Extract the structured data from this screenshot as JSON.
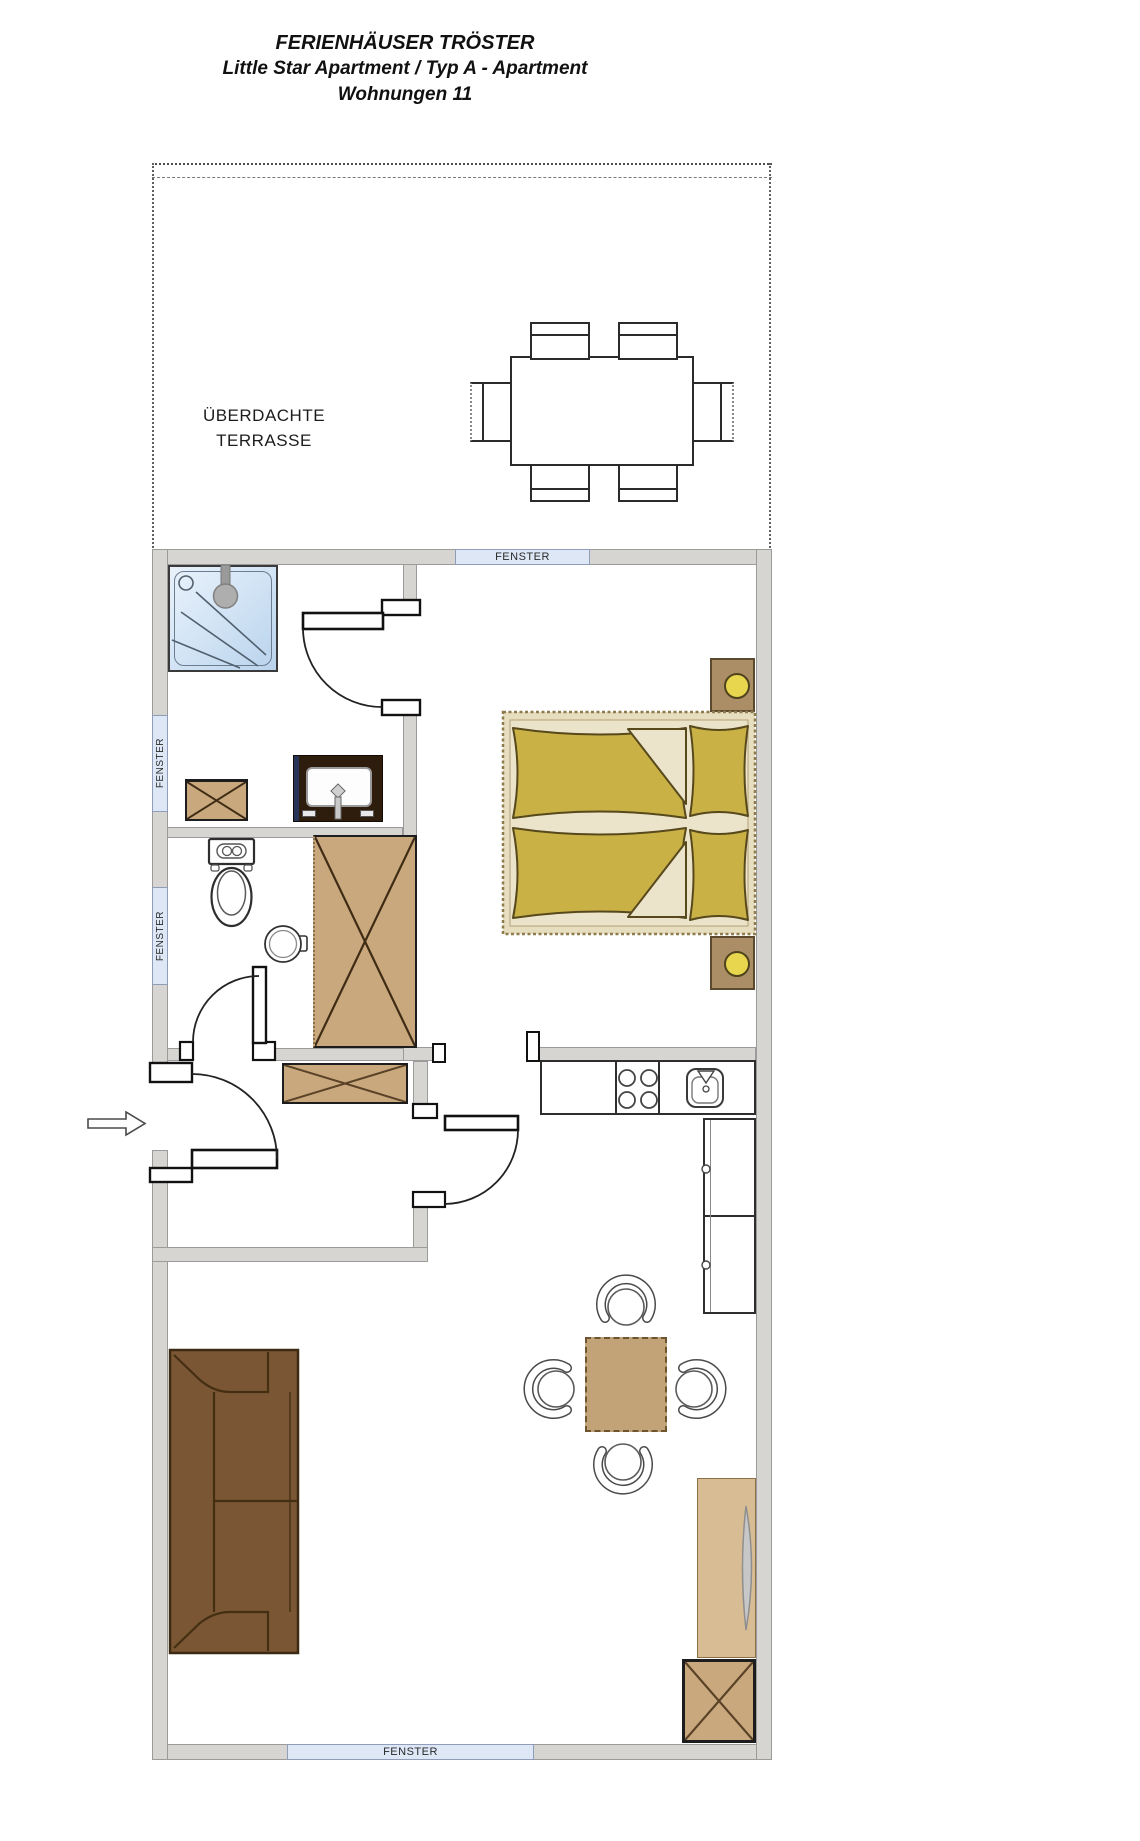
{
  "title": {
    "line1": "FERIENHÄUSER TRÖSTER",
    "line2": "Little Star Apartment / Typ A - Apartment",
    "line3": "Wohnungen 11"
  },
  "terrace": {
    "label_line1": "ÜBERDACHTE",
    "label_line2": "TERRASSE"
  },
  "windows": {
    "top": {
      "label": "FENSTER"
    },
    "left_upper": {
      "label": "FENSTER"
    },
    "left_lower": {
      "label": "FENSTER"
    },
    "bottom": {
      "label": "FENSTER"
    }
  },
  "fixtures": [
    "covered-terrace-dining-table",
    "terrace-chairs",
    "shower",
    "vanity-sink",
    "washer-cabinet",
    "toilet",
    "hand-basin",
    "wardrobe",
    "double-bed",
    "nightstand-with-lamp",
    "nightstand-with-lamp",
    "kitchen-counter",
    "stove-burners",
    "kitchen-sink",
    "tall-cabinet",
    "dining-table",
    "dining-chairs",
    "sofa",
    "tv-sideboard",
    "storage-box",
    "shoe-cabinet",
    "entry-arrow",
    "door-swings"
  ],
  "palette": {
    "wall_fill": "#d7d5d2",
    "window_blue": "#dde7f6",
    "furniture_tan": "#c9a87e",
    "bed_olive": "#c9b146",
    "bed_cream": "#ece4ca",
    "sofa_brown": "#7a5634",
    "lamp_yellow": "#e9d64f",
    "shower_blue": "#cfe2f4",
    "vanity_brown": "#2e1c0c"
  }
}
